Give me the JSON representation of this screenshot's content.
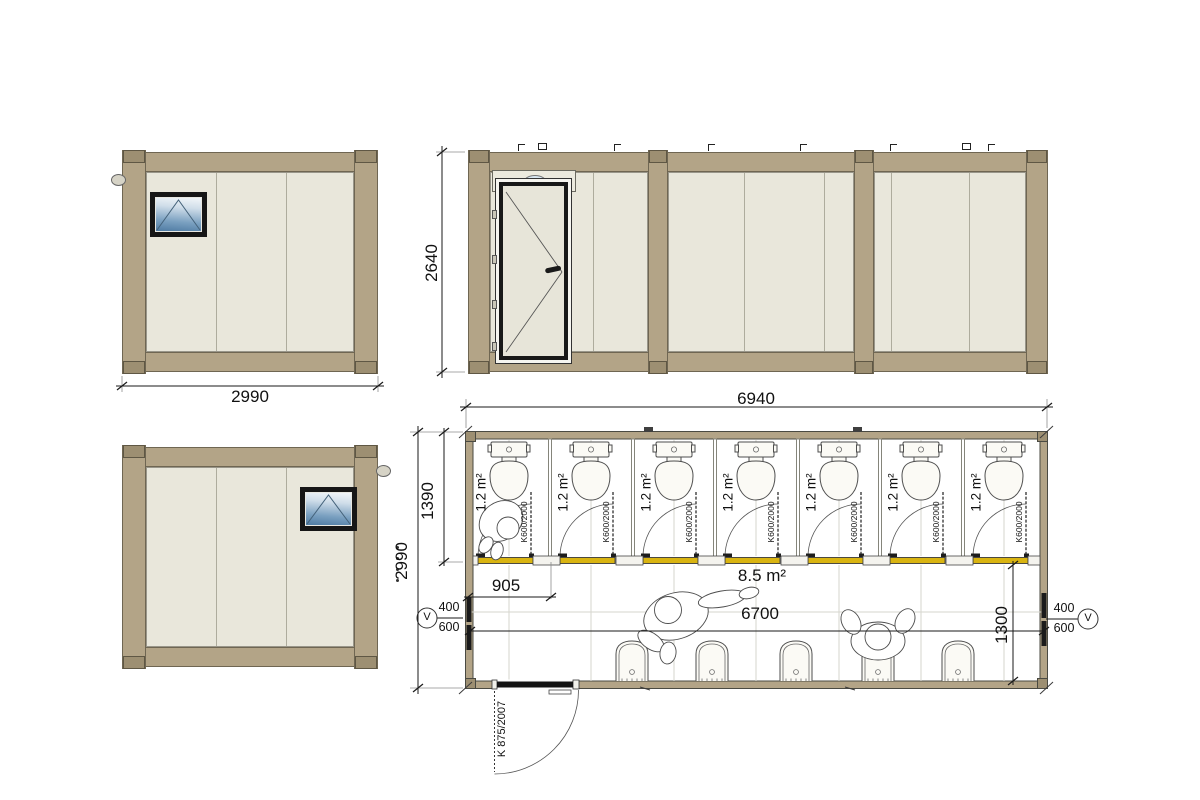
{
  "drawing_type": "sanitary-container technical drawing",
  "views": {
    "side_a": {
      "dim_width": "2990"
    },
    "front": {
      "dim_height": "2640"
    },
    "side_b": {},
    "plan": {
      "dim_width_top": "6940",
      "dim_total_depth": "2990",
      "dim_cubicle_depth": "1390",
      "dim_first_cubicle": "905",
      "area_room": "8.5 m²",
      "dim_room_length": "6700",
      "dim_room_depth": "1300",
      "entrance_door_code": "K 875/2007",
      "vent_left": {
        "top": "400",
        "bottom": "600",
        "symbol": "V"
      },
      "vent_right": {
        "top": "400",
        "bottom": "600",
        "symbol": "V"
      },
      "cubicles": [
        {
          "area": "1.2 m²",
          "door_code": "K600/2000"
        },
        {
          "area": "1.2 m²",
          "door_code": "K600/2000"
        },
        {
          "area": "1.2 m²",
          "door_code": "K600/2000"
        },
        {
          "area": "1.2 m²",
          "door_code": "K600/2000"
        },
        {
          "area": "1.2 m²",
          "door_code": "K600/2000"
        },
        {
          "area": "1.2 m²",
          "door_code": "K600/2000"
        },
        {
          "area": "1.2 m²",
          "door_code": "K600/2000"
        }
      ],
      "basin_count": 5,
      "toilet_count": 7
    }
  },
  "colors": {
    "frame_tan": "#b3a487",
    "panel_cream": "#e9e7db",
    "threshold_yellow": "#d9b411",
    "window_glass_blue": "#6d92b4",
    "line_dark": "#1a1a1a"
  }
}
